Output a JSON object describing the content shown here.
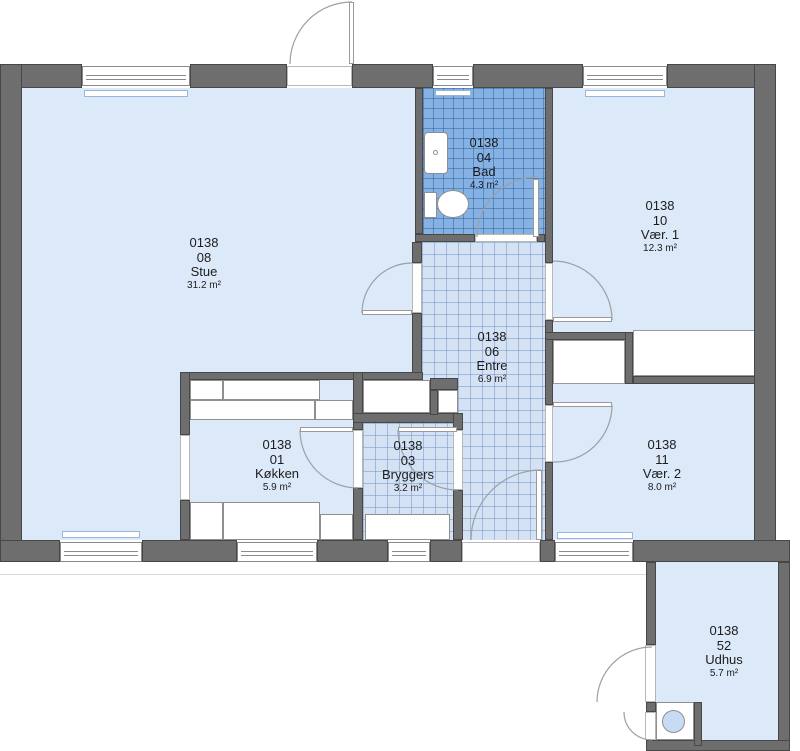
{
  "plan": {
    "building_id": "0138",
    "type": "floor-plan",
    "rooms": [
      {
        "id": "0138",
        "number": "08",
        "name": "Stue",
        "area": "31.2 m²"
      },
      {
        "id": "0138",
        "number": "04",
        "name": "Bad",
        "area": "4.3 m²"
      },
      {
        "id": "0138",
        "number": "10",
        "name": "Vær. 1",
        "area": "12.3 m²"
      },
      {
        "id": "0138",
        "number": "06",
        "name": "Entre",
        "area": "6.9 m²"
      },
      {
        "id": "0138",
        "number": "01",
        "name": "Køkken",
        "area": "5.9 m²"
      },
      {
        "id": "0138",
        "number": "03",
        "name": "Bryggers",
        "area": "3.2 m²"
      },
      {
        "id": "0138",
        "number": "11",
        "name": "Vær. 2",
        "area": "8.0 m²"
      },
      {
        "id": "0138",
        "number": "52",
        "name": "Udhus",
        "area": "5.7 m²"
      }
    ],
    "colors": {
      "wall": "#6e6e6e",
      "room_fill": "#dce9f9",
      "bath_tile": "#85b2e3",
      "hall_tile": "#d4e2f4",
      "fixture_outline": "#8f8f8f"
    }
  }
}
